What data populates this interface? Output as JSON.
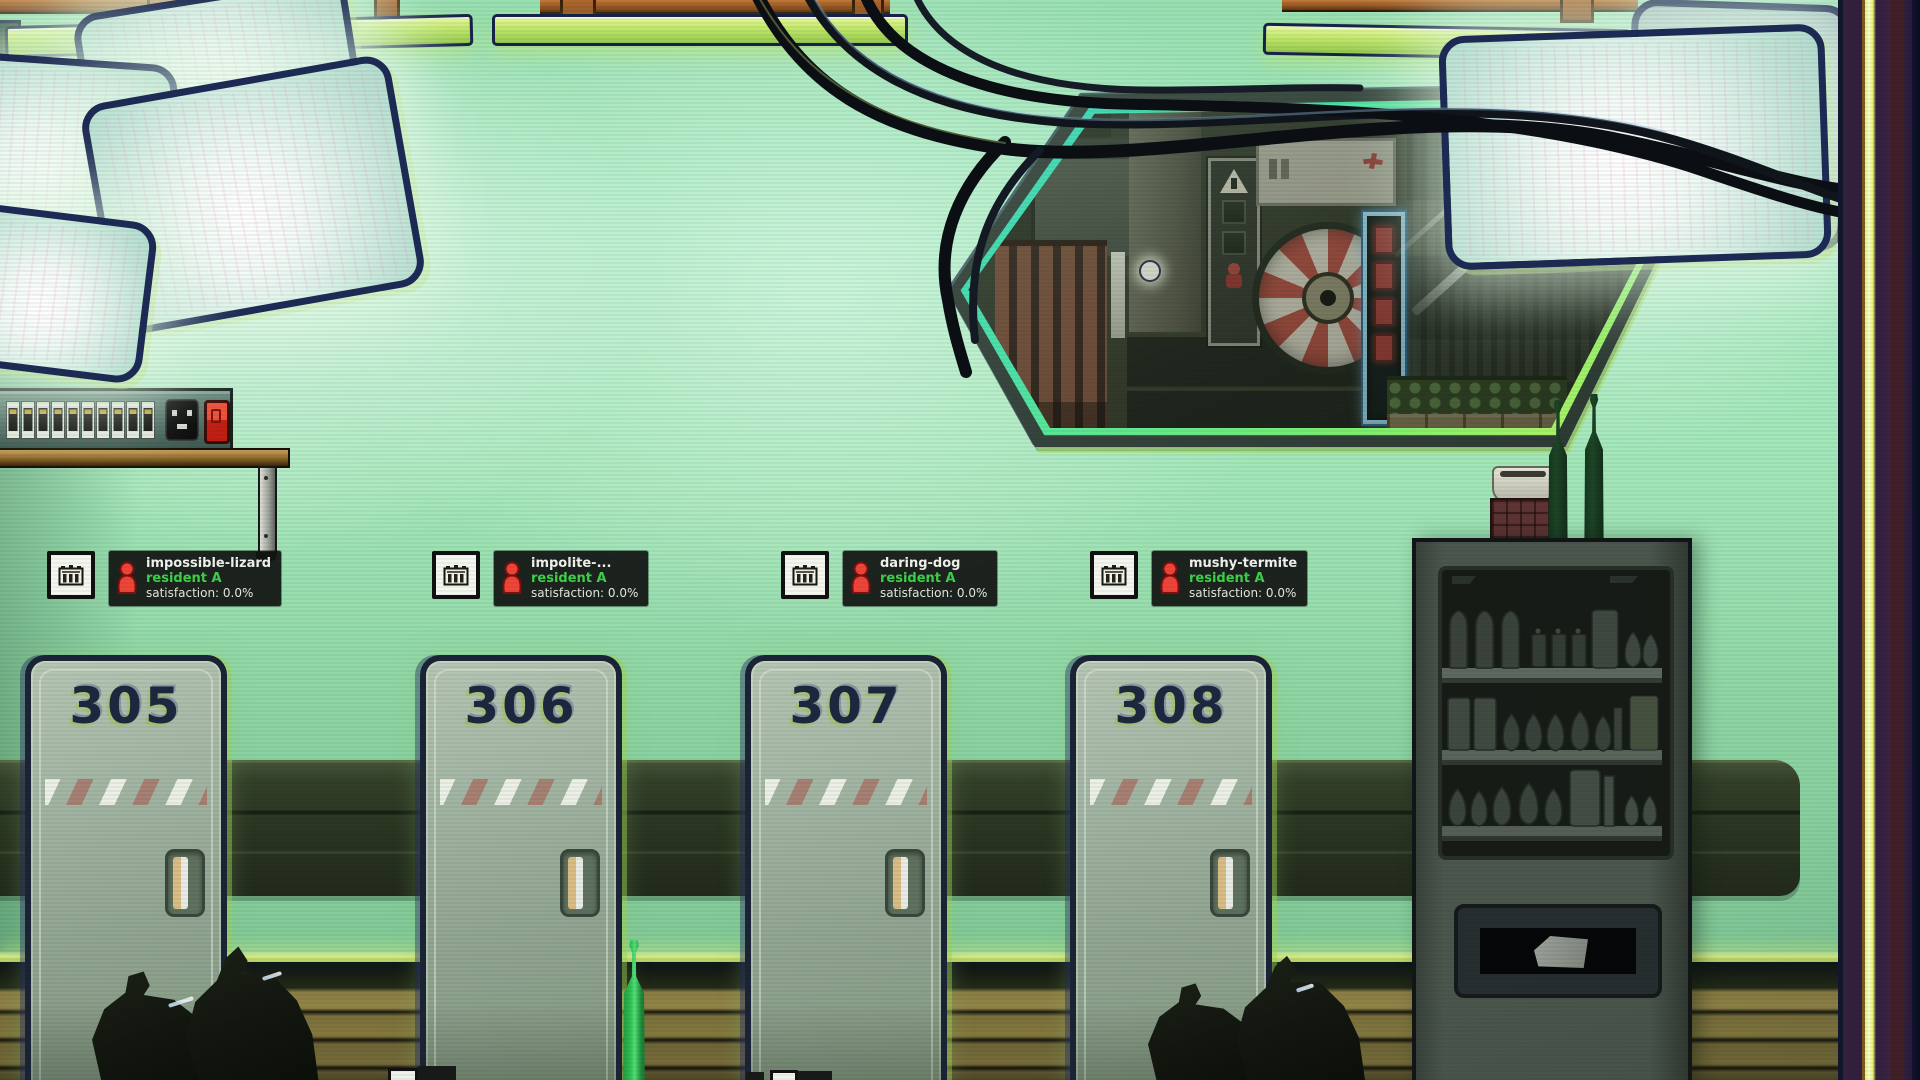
{
  "doors": [
    {
      "number": "305"
    },
    {
      "number": "306"
    },
    {
      "number": "307"
    },
    {
      "number": "308"
    }
  ],
  "residents": [
    {
      "name": "impossible-lizard",
      "role": "resident A",
      "satisfaction": "satisfaction: 0.0%"
    },
    {
      "name": "impolite-...",
      "role": "resident A",
      "satisfaction": "satisfaction: 0.0%"
    },
    {
      "name": "daring-dog",
      "role": "resident A",
      "satisfaction": "satisfaction: 0.0%"
    },
    {
      "name": "mushy-termite",
      "role": "resident A",
      "satisfaction": "satisfaction: 0.0%"
    }
  ],
  "icons": {
    "room": "room-icon",
    "resident": "resident-icon"
  },
  "colors": {
    "wall_green": "#9fe4b6",
    "accent_lime": "#cdf06e",
    "label_panel_bg": "#141614",
    "resident_name_white": "#f2f2ee",
    "resident_role_green": "#3ed14a",
    "resident_icon_red": "#ef4438",
    "door_number_navy": "#1d2840",
    "window_rim_teal": "#3fd4c2",
    "wall_trim_purple": "#33203f",
    "wall_trim_yellow": "#e6f26a"
  }
}
